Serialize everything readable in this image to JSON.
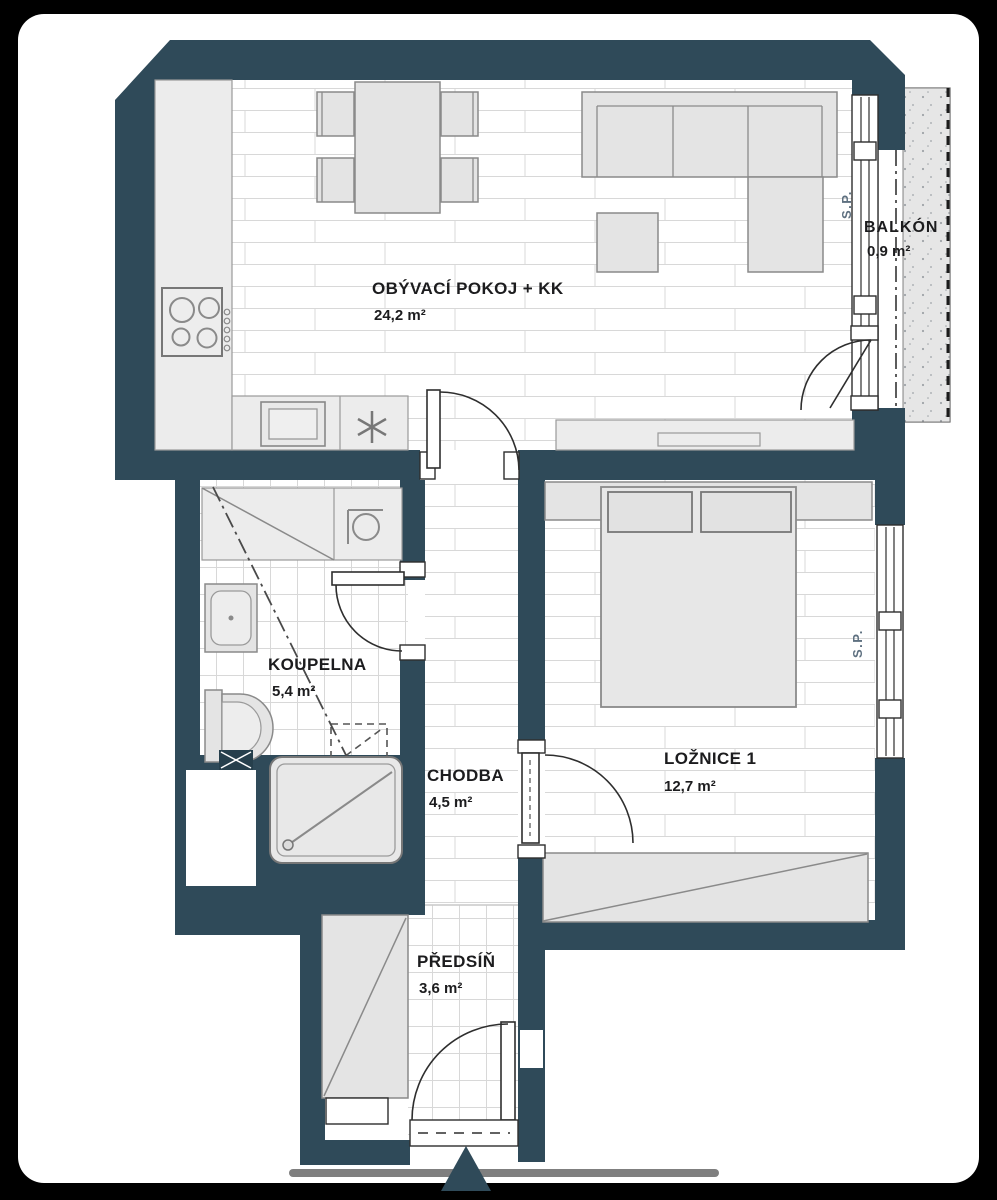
{
  "plan": {
    "rooms": {
      "living": {
        "name": "OBÝVACÍ POKOJ + KK",
        "area": "24,2 m²"
      },
      "balcony": {
        "name": "BALKÓN",
        "area": "0,9 m²"
      },
      "bathroom": {
        "name": "KOUPELNA",
        "area": "5,4 m²"
      },
      "hallway": {
        "name": "CHODBA",
        "area": "4,5 m²"
      },
      "bedroom": {
        "name": "LOŽNICE 1",
        "area": "12,7 m²"
      },
      "entry": {
        "name": "PŘEDSÍŇ",
        "area": "3,6 m²"
      }
    },
    "window_labels": {
      "living": "S.P.",
      "bedroom": "S.P."
    },
    "colors": {
      "wall": "#2F4A59",
      "card_background": "#FFFFFF",
      "frame_background": "#000000",
      "furniture_fill": "#E4E4E4",
      "furniture_stroke": "#8A8A8A",
      "floor_line": "#D8D8D8",
      "label_text": "#1C1C1E",
      "window_label_text": "#5E7080",
      "entrance_marker": "#2F4A59",
      "progress_bar": "#7F7F7F"
    }
  }
}
